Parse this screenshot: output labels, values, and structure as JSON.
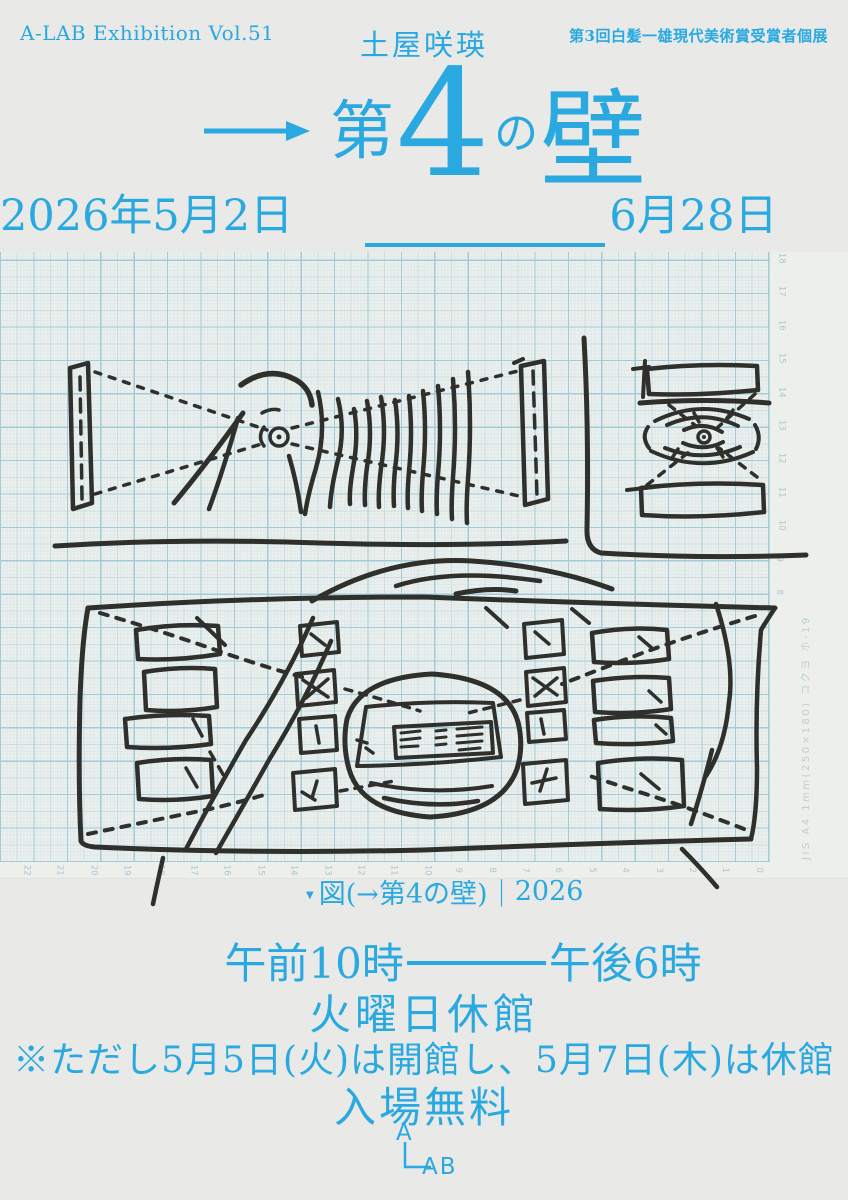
{
  "palette": {
    "accent": "#29a9e0",
    "background": "#e9e9e7",
    "paper": "#edefeb",
    "ink": "#2f2f2b",
    "grid_major": "#9fccd8",
    "grid_minor": "#dde9ec",
    "margin_text": "#b7d0d8"
  },
  "header": {
    "series": "A-LAB Exhibition Vol.51",
    "artist": "土屋咲瑛",
    "award_note": "第3回白髪一雄現代美術賞受賞者個展"
  },
  "title": {
    "arrow_symbol": "→",
    "part_dai": "第",
    "part_four": "4",
    "part_no": "の",
    "part_kabe": "壁"
  },
  "dates": {
    "start": "2026年5月2日(土)",
    "end": "6月28日(日)"
  },
  "artwork": {
    "caption_marker": "▼",
    "caption_title": "図(→第4の壁)",
    "caption_separator": "|",
    "caption_year": "2026",
    "paper_spec": "JIS A4  1mm(250×180)  コクヨ  ホ-19",
    "bottom_scale": [
      "22",
      "21",
      "20",
      "19",
      "18",
      "17",
      "16",
      "15",
      "14",
      "13",
      "12",
      "11",
      "10",
      "9",
      "8",
      "7",
      "6",
      "5",
      "4",
      "3",
      "2",
      "1",
      "0"
    ],
    "right_scale": [
      "18",
      "17",
      "16",
      "15",
      "14",
      "13",
      "12",
      "11",
      "10",
      "9",
      "8"
    ]
  },
  "info": {
    "hours_start": "午前10時",
    "hours_end": "午後6時",
    "closed": "火曜日休館",
    "exception": "※ただし5月5日(火)は開館し、5月7日(木)は休館",
    "admission": "入場無料"
  },
  "logo": {
    "top_letter": "A",
    "bottom_letters": "AB"
  }
}
